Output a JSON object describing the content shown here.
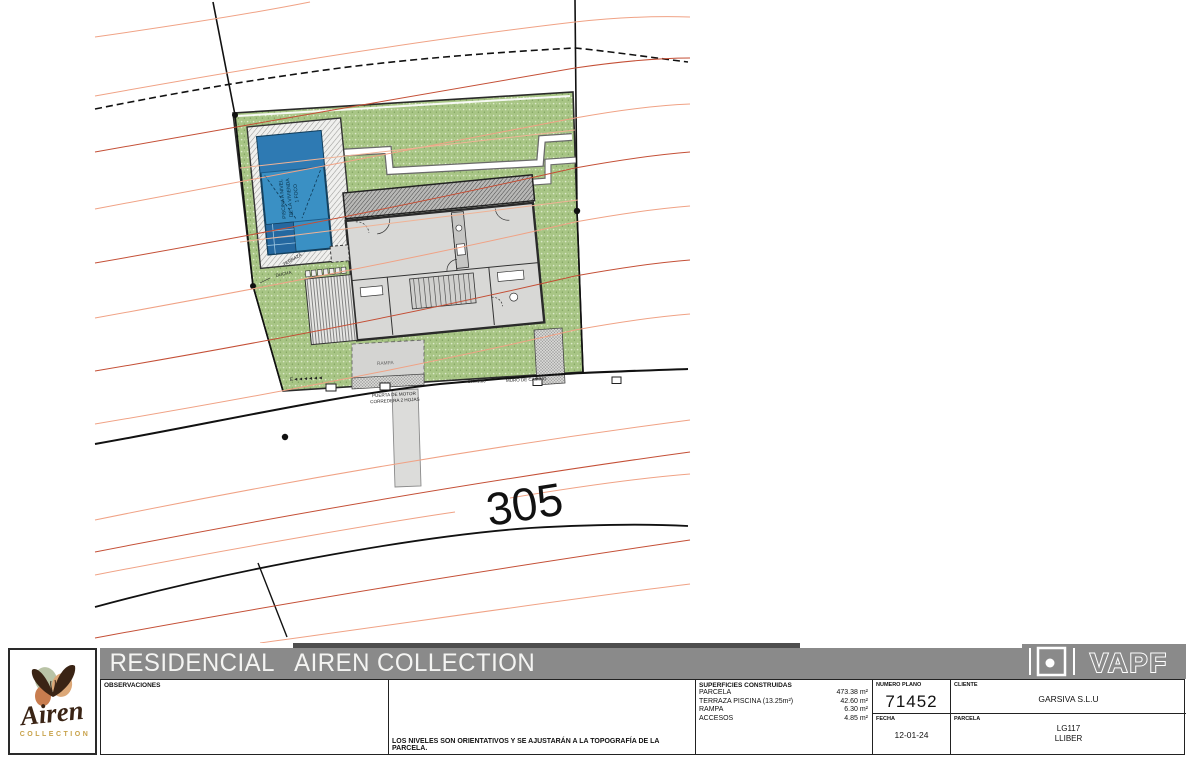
{
  "sheet": {
    "title": "RESIDENCIAL   AIREN COLLECTION"
  },
  "brand": {
    "airen_name": "Airen",
    "airen_sub": "COLLECTION",
    "vapf_name": "VAPF"
  },
  "title_block": {
    "observaciones_label": "OBSERVACIONES",
    "niveles_note": "LOS NIVELES SON ORIENTATIVOS Y SE AJUSTARÁN A LA TOPOGRAFÍA DE LA PARCELA.",
    "superficies": {
      "label": "SUPERFICIES CONSTRUIDAS",
      "rows": [
        {
          "name": "PARCELA",
          "value": "473.38 m²"
        },
        {
          "name": "TERRAZA PISCINA (13.25m²)",
          "value": "42.60 m²"
        },
        {
          "name": "RAMPA",
          "value": "6.30 m²"
        },
        {
          "name": "ACCESOS",
          "value": "4.85 m²"
        }
      ]
    },
    "numero_plano": {
      "label": "NUMERO PLANO",
      "value": "71452"
    },
    "fecha": {
      "label": "FECHA",
      "value": "12-01-24"
    },
    "cliente": {
      "label": "CLIENTE",
      "value": "GARSIVA S.L.U"
    },
    "parcela": {
      "label": "PARCELA",
      "value_line1": "LG117",
      "value_line2": "LLIBER"
    }
  },
  "drawing": {
    "contour_elevation_label": "305",
    "labels": {
      "terraza": "TERRAZA",
      "ducha": "DUCHA",
      "rampa": "RAMPA",
      "puerta_line1": "PUERTA DE MOTOR",
      "puerta_line2": "CORREDERA 2 HOJAS",
      "gate_size": "100x1.30",
      "muro_camino": "MURO DE CAMINO",
      "pool_line1": "PISCINA A NIVEL",
      "pool_line2": "DE LA VIVIENDA",
      "pool_line3": "1 FOCO",
      "fence_symbol": "E◄◄◄◄◄◄"
    },
    "colors": {
      "grass": "#a8c585",
      "pool_water": "#3a90c4",
      "contour_line": "#c44f36",
      "contour_line_light": "#f0a285",
      "boundary": "#111111",
      "title_bar_gray": "#8a8a8a"
    }
  }
}
